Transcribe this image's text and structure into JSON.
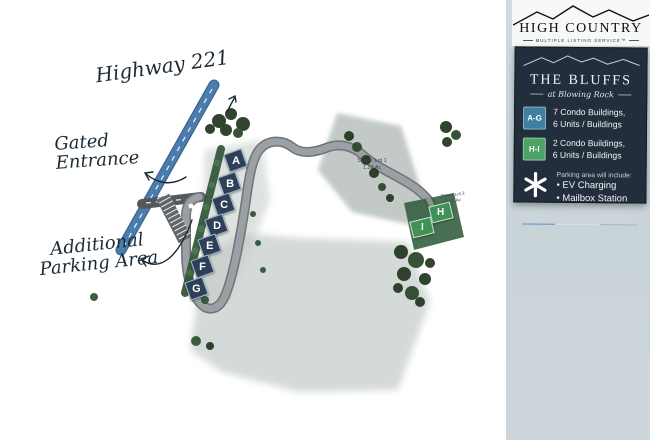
{
  "logo": {
    "title": "HIGH COUNTRY",
    "subtitle": "MULTIPLE LISTING SERVICE™"
  },
  "legend": {
    "title": "THE BLUFFS",
    "subtitle": "at Blowing Rock",
    "panel_color": "#222e3b",
    "items": [
      {
        "badge": "A-G",
        "color": "#3f7f9f",
        "label_line1": "7 Condo Buildings,",
        "label_line2": "6 Units / Buildings"
      },
      {
        "badge": "H-I",
        "color": "#4da266",
        "label_line1": "2 Condo Buildings,",
        "label_line2": "6 Units / Buildings"
      }
    ],
    "parking_note": {
      "heading": "Parking area will include:",
      "bullet1": "• EV Charging",
      "bullet2": "• Mailbox Station"
    },
    "footer": {
      "left": "CATON GAP",
      "middle": "VEGETATIVE SCREENING BUFFER",
      "right": "HIGHWAY 221"
    }
  },
  "map": {
    "labels": {
      "highway": "Highway 221",
      "gated_entrance": "Gated Entrance",
      "additional_parking_line1": "Additional",
      "additional_parking_line2": "Parking Area"
    },
    "buildings_ag": [
      "A",
      "B",
      "C",
      "D",
      "E",
      "F",
      "G"
    ],
    "buildings_hi": [
      "H",
      "I"
    ],
    "lot1": {
      "name": "Slover Lot 1",
      "area": "1.23 Ac"
    },
    "lot2": {
      "name": "Slover Lot 2",
      "area": "1.17 Ac"
    },
    "colors": {
      "highway": "#4b7cab",
      "road": "#9aa0a3",
      "building_ag": "#2e4058",
      "building_hi": "#3f9156"
    }
  }
}
